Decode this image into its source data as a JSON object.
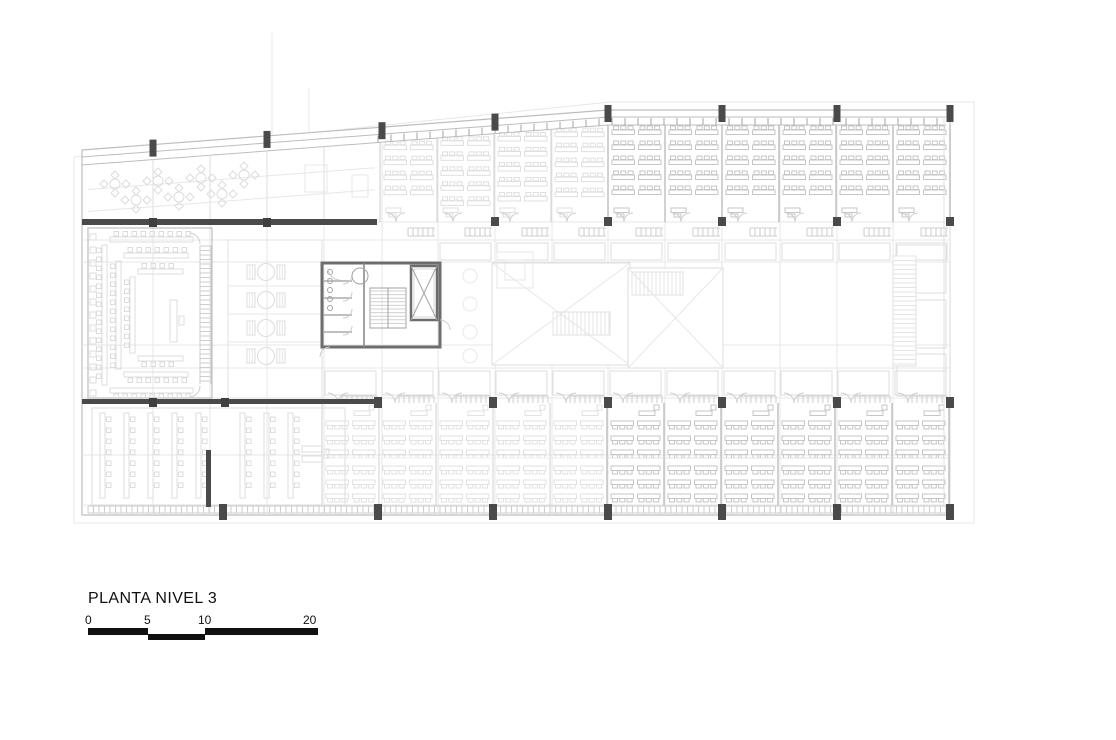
{
  "title": "PLANTA NIVEL 3",
  "scale_bar": {
    "labels": [
      "0",
      "5",
      "10",
      "20"
    ],
    "segments": [
      {
        "from": 0,
        "to": 5,
        "row": "top"
      },
      {
        "from": 5,
        "to": 10,
        "row": "bottom"
      },
      {
        "from": 10,
        "to": 20,
        "row": "top"
      }
    ]
  },
  "colors": {
    "paper": "#ffffff",
    "ink": "#111111",
    "faint": "#e7e7e7",
    "furn_faint": "#dcdcdc",
    "desk": "#c6c6c6",
    "light_wall": "#bdbdbd",
    "mid": "#a3a3a3",
    "tick": "#cdcdcd",
    "core_wall": "#6d6d6d",
    "column": "#4a4a4a"
  },
  "plan": {
    "label": "third-floor-plan",
    "building_outline": [
      [
        82,
        150
      ],
      [
        608,
        110
      ],
      [
        950,
        110
      ],
      [
        950,
        515
      ],
      [
        82,
        515
      ]
    ],
    "site_outline": [
      [
        74,
        157
      ],
      [
        610,
        102
      ],
      [
        974,
        102
      ],
      [
        974,
        523
      ],
      [
        74,
        523
      ]
    ],
    "slant": {
      "x0": 82,
      "y0": 150,
      "x1": 608,
      "y1": 110
    },
    "grid_x_major": [
      153,
      267,
      382,
      495,
      608,
      722,
      837,
      950
    ],
    "grid_x_minor": [
      210,
      324,
      438,
      552,
      665,
      780,
      893
    ],
    "grid_y": [
      222,
      240,
      262,
      345,
      368,
      398,
      455,
      505
    ],
    "stub_lines": [
      [
        272,
        33,
        272,
        136
      ],
      [
        309,
        88,
        309,
        133
      ]
    ],
    "classrooms_top": {
      "x0": 380,
      "room_w": 57,
      "count": 10,
      "rows_to_y": 202,
      "row_step": 15,
      "front_wall_y": 222,
      "faint_before_x": 608
    },
    "classrooms_bottom": {
      "x0": 322,
      "room_w": 57,
      "count": 11,
      "y_top": 403,
      "y_bottom": 505,
      "mid_wall_y": 458,
      "rows": [
        421,
        436,
        450,
        466,
        480,
        494
      ],
      "faint_before_x": 607
    },
    "cores": [
      {
        "x": 322,
        "y": 263,
        "w": 118,
        "h": 84,
        "mirror": false
      },
      {
        "x": 768,
        "y": 263,
        "w": 118,
        "h": 84,
        "mirror": true
      }
    ],
    "assembly": {
      "x": 88,
      "y": 228,
      "w": 124,
      "h": 170,
      "nested_rows": 3
    },
    "meeting": {
      "cx": 266,
      "table_ys": [
        272,
        300,
        328,
        356
      ],
      "room_x": 228,
      "room_w": 94
    },
    "lab": {
      "x": 92,
      "y": 408,
      "w": 253,
      "h": 97,
      "strips_left": [
        100,
        124,
        148,
        172,
        196
      ],
      "strips_right": [
        240,
        264,
        288
      ]
    },
    "atriums": [
      {
        "x": 492,
        "y": 263,
        "w": 138,
        "h": 102,
        "hatch": [
          553,
          312,
          57,
          23
        ]
      },
      {
        "x": 628,
        "y": 268,
        "w": 95,
        "h": 100,
        "hatch": [
          632,
          272,
          51,
          23
        ]
      }
    ],
    "lounge_clusters": [
      [
        115,
        184
      ],
      [
        158,
        181
      ],
      [
        201,
        178
      ],
      [
        244,
        175
      ],
      [
        136,
        200
      ],
      [
        179,
        197
      ],
      [
        222,
        194
      ]
    ],
    "lounge_furniture": [
      [
        305,
        165,
        22,
        27
      ],
      [
        352,
        175,
        16,
        22
      ],
      [
        497,
        252,
        36,
        36
      ],
      [
        505,
        260,
        20,
        20
      ]
    ],
    "side_tables_x": 470,
    "side_tables_ys": [
      276,
      304,
      332,
      356
    ],
    "core2_hatch_band": [
      893,
      256,
      23,
      110
    ],
    "columns_y222": [
      495,
      608,
      722,
      837,
      950
    ],
    "columns_y402": [
      378,
      493,
      608,
      722,
      837,
      950
    ],
    "columns_bottom": [
      223,
      378,
      493,
      608,
      722,
      837,
      950
    ],
    "dark_walls": [
      [
        82,
        219,
        295,
        6
      ],
      [
        82,
        399,
        296,
        5
      ]
    ],
    "dark_bar": [
      206,
      450,
      5,
      57
    ]
  }
}
